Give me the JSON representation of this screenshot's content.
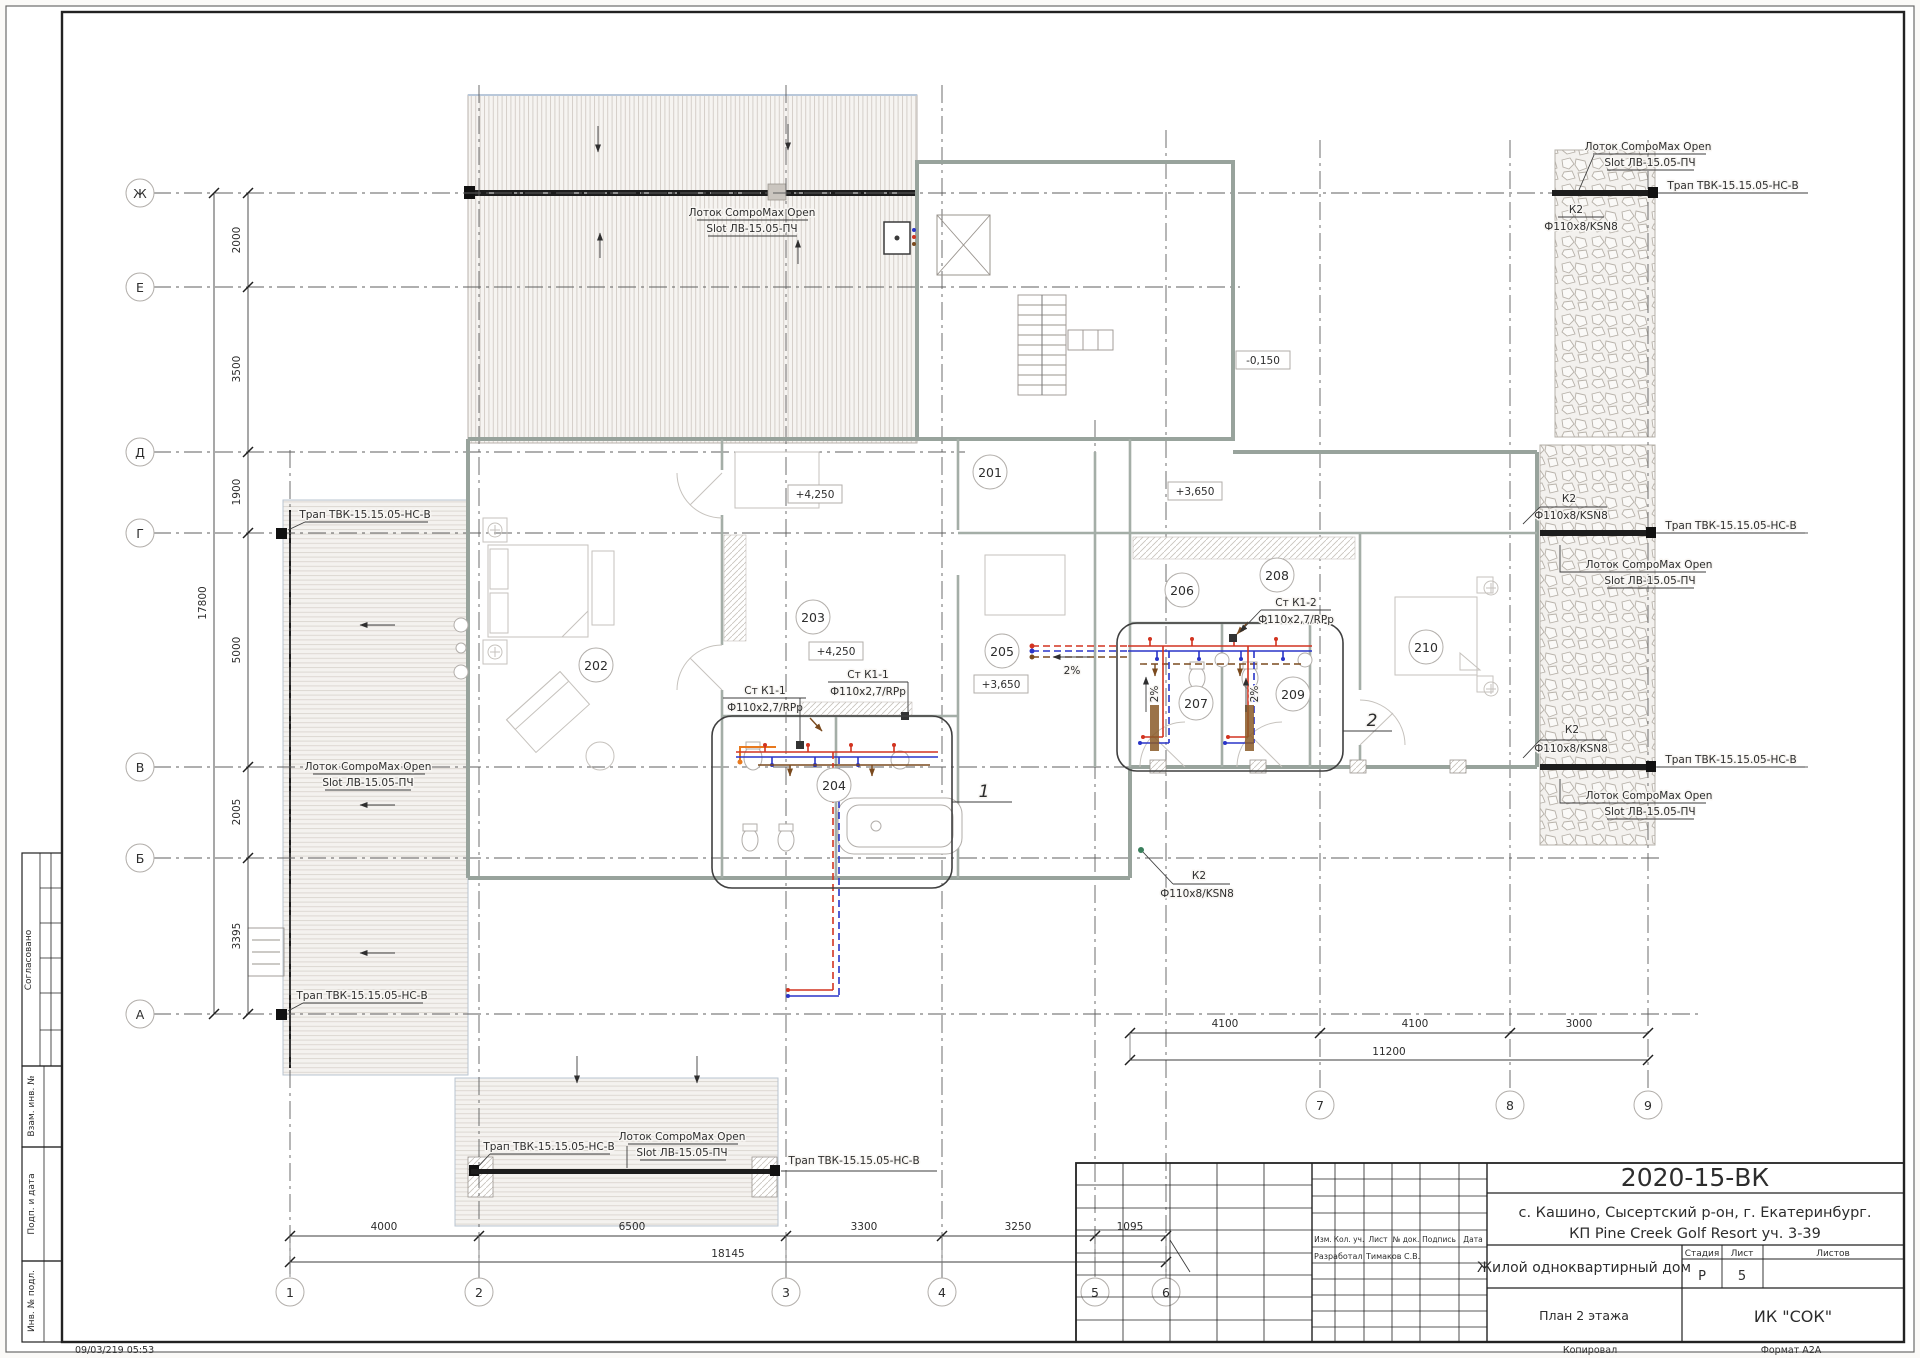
{
  "plan": {
    "axis_rows": [
      "Ж",
      "Е",
      "Д",
      "Г",
      "В",
      "Б",
      "А"
    ],
    "axis_cols": [
      "1",
      "2",
      "3",
      "4",
      "5",
      "6",
      "7",
      "8",
      "9"
    ],
    "dim_left": {
      "segments": [
        "2000",
        "3500",
        "1900",
        "5000",
        "2005",
        "3395"
      ],
      "total": "17800"
    },
    "dim_bottom": {
      "segments": [
        "4000",
        "6500",
        "3300",
        "3250",
        "1095"
      ],
      "total": "18145"
    },
    "dim_right": {
      "segments": [
        "4100",
        "4100",
        "3000"
      ],
      "total": "11200"
    },
    "rooms": [
      "201",
      "202",
      "203",
      "204",
      "205",
      "206",
      "207",
      "208",
      "209",
      "210"
    ],
    "elevations": {
      "e1": "+4,250",
      "e2": "+3,650",
      "e3": "-0,150",
      "e4": "+4,250",
      "e5": "+3,650"
    },
    "labels": {
      "gutter1": "Лоток CompoMax Open",
      "gutter2": "Slot ЛВ-15.05-ПЧ",
      "drain": "Трап ТВК-15.15.05-НС-В",
      "k2": "К2",
      "k2_pipe": "Ф110х8/KSN8",
      "stack_k11": "Ст К1-1",
      "stack_k12": "Ст К1-2",
      "stack_pipe": "Ф110х2,7/RPp",
      "slope": "2%",
      "callout_1": "1",
      "callout_2": "2"
    }
  },
  "title_block": {
    "doc_number": "2020-15-ВК",
    "location1": "с. Кашино, Сысертский р-он, г. Екатеринбург.",
    "location2": "КП Pine Creek Golf Resort уч. 3-39",
    "object_name": "Жилой одноквартирный дом",
    "sheet_title": "План 2 этажа",
    "company": "ИК \"СОК\"",
    "stage_label": "Стадия",
    "sheet_label": "Лист",
    "sheets_label": "Листов",
    "stage": "Р",
    "sheet": "5",
    "col_izm": "Изм.",
    "col_kol": "Кол. уч.",
    "col_list": "Лист",
    "col_doc": "№ док.",
    "col_sign": "Подпись",
    "col_date": "Дата",
    "developed_label": "Разработал",
    "developed_by": "Тимаков С.В."
  },
  "stamps": {
    "agreed": "Согласовано",
    "vzam": "Взам. инв. №",
    "podp": "Подп. и дата",
    "inv": "Инв. № подл."
  },
  "footer": {
    "timestamp": "09/03/219 05:53",
    "copied": "Копировал",
    "format": "Формат А2А"
  }
}
